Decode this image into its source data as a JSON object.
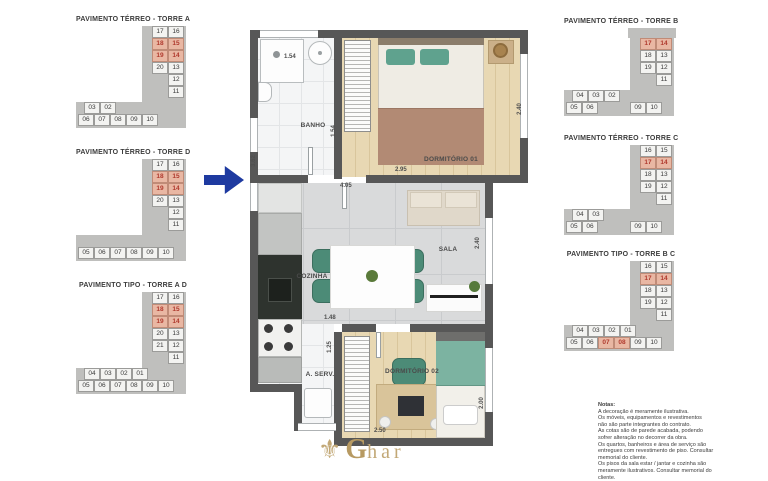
{
  "site_plans": {
    "left": [
      {
        "title": "PAVIMENTO TÉRREO - TORRE A",
        "top_block": false,
        "left_col": [
          "17",
          "18",
          "19",
          "20"
        ],
        "right_col": [
          "16",
          "15",
          "14",
          "13",
          "12",
          "11"
        ],
        "mid_row": [
          "03",
          "02"
        ],
        "bottom_row": [
          "06",
          "07",
          "08",
          "09",
          "10"
        ],
        "highlights": [
          "18",
          "15",
          "19",
          "14"
        ]
      },
      {
        "title": "PAVIMENTO TÉRREO - TORRE D",
        "top_block": false,
        "left_col": [
          "17",
          "18",
          "19",
          "20"
        ],
        "right_col": [
          "16",
          "15",
          "14",
          "13",
          "12",
          "11"
        ],
        "mid_row": [],
        "bottom_row": [
          "05",
          "06",
          "07",
          "08",
          "09",
          "10"
        ],
        "highlights": [
          "18",
          "15",
          "19",
          "14"
        ]
      },
      {
        "title": "PAVIMENTO TIPO - TORRE A D",
        "top_block": false,
        "left_col": [
          "17",
          "18",
          "19",
          "20",
          "21"
        ],
        "right_col": [
          "16",
          "15",
          "14",
          "13",
          "12",
          "11"
        ],
        "mid_row": [
          "04",
          "03",
          "02",
          "01"
        ],
        "bottom_row": [
          "05",
          "06",
          "07",
          "08",
          "09",
          "10"
        ],
        "highlights": [
          "18",
          "15",
          "19",
          "14"
        ]
      }
    ],
    "right": [
      {
        "title": "PAVIMENTO TÉRREO - TORRE B",
        "top_block": true,
        "left_col": [
          "17",
          "18",
          "19"
        ],
        "right_col": [
          "14",
          "13",
          "12",
          "11"
        ],
        "mid_row": [
          "04",
          "03",
          "02"
        ],
        "bottom_row": [
          "05",
          "06",
          "",
          "",
          "09",
          "10"
        ],
        "highlights": [
          "17",
          "14"
        ]
      },
      {
        "title": "PAVIMENTO TÉRREO - TORRE C",
        "top_block": false,
        "left_col": [
          "16",
          "17",
          "18",
          "19"
        ],
        "right_col": [
          "15",
          "14",
          "13",
          "12",
          "11"
        ],
        "mid_row": [
          "04",
          "03"
        ],
        "bottom_row": [
          "05",
          "06",
          "",
          "",
          "09",
          "10"
        ],
        "highlights": [
          "17",
          "14"
        ]
      },
      {
        "title": "PAVIMENTO TIPO - TORRE B C",
        "top_block": false,
        "left_col": [
          "16",
          "17",
          "18",
          "19"
        ],
        "right_col": [
          "15",
          "14",
          "13",
          "12",
          "11"
        ],
        "mid_row": [
          "04",
          "03",
          "02",
          "01"
        ],
        "bottom_row": [
          "05",
          "06",
          "07",
          "08",
          "09",
          "10"
        ],
        "highlights": [
          "17",
          "14",
          "07",
          "08"
        ]
      }
    ]
  },
  "floorplan": {
    "labels": {
      "banho": "BANHO",
      "dormitorio_01": "DORMITÓRIO 01",
      "cozinha": "COZINHA",
      "sala": "SALA",
      "a_serv": "A. SERV.",
      "dormitorio_02": "DORMITÓRIO 02"
    },
    "dims": {
      "banho_width": "1.54",
      "banho_depth": "1.54",
      "dorm1_width": "2.95",
      "dorm1_depth": "2.40",
      "living_width": "4.05",
      "kitchen_depth": "3.62",
      "table_width": "1.48",
      "serv_depth": "1.25",
      "sala_depth": "2.40",
      "dorm2_width": "2.50",
      "dorm2_depth": "2.00"
    }
  },
  "colors": {
    "wall": "#575757",
    "highlight_bg": "#e9b7a3",
    "highlight_text": "#b03a2e",
    "arrow_blue": "#1e3aa0",
    "logo_gold": "#b79a62",
    "chair_teal": "#4c8b77"
  },
  "notes": {
    "title": "Notas:",
    "text": "A decoração é meramente ilustrativa.\nOs móveis, equipamentos e revestimentos\nnão são parte integrantes do contrato.\nAs cotas são de parede acabada, podendo\nsofrer alteração no decorrer da obra.\nOs quartos, banheiros e área de serviço são\nentregues com revestimento de piso. Consultar\nmemorial do cliente.\nOs pisos da sala estar / jantar e cozinha são\nmeramente ilustrativos. Consultar memorial do\ncliente."
  },
  "logo": {
    "g": "G",
    "rest": "har"
  }
}
